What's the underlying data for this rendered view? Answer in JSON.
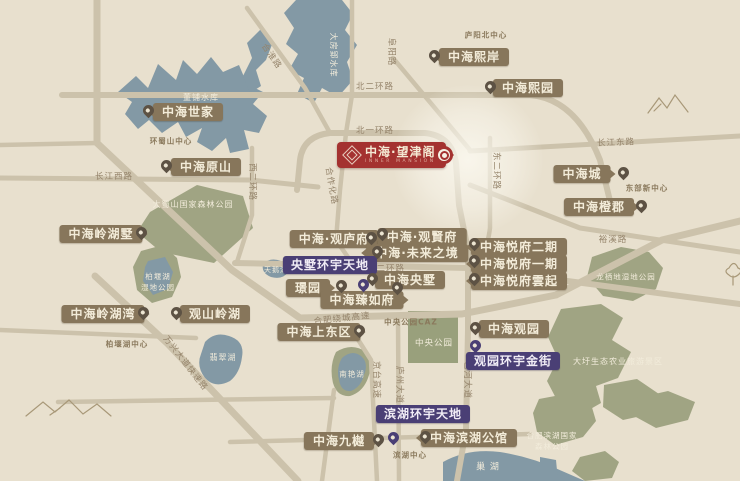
{
  "badge": {
    "name": "中海·望津阁",
    "subtitle": "INNER MANSION",
    "logo": "zhonghai-diamond"
  },
  "colors": {
    "accent_red": "#a43230",
    "label_brown": "#87765b",
    "hub_purple": "#4a3f75",
    "water_blue": "#8399a5",
    "park_green": "#a0a483",
    "road_tan": "#ccc2ab",
    "background": "#e8e0ce",
    "pin_brown": "#5d5244",
    "label_text": "#f3ecd9"
  },
  "projects": [
    {
      "label": "中海世家",
      "x": 188,
      "y": 112,
      "pin_x": 148,
      "pin_y": 118,
      "pin_side": "left"
    },
    {
      "label": "中海原山",
      "x": 206,
      "y": 167,
      "pin_x": 166,
      "pin_y": 173,
      "pin_side": "left"
    },
    {
      "label": "中海熙岸",
      "x": 474,
      "y": 57,
      "pin_x": 434,
      "pin_y": 63,
      "pin_side": "left"
    },
    {
      "label": "中海熙园",
      "x": 528,
      "y": 88,
      "pin_x": 490,
      "pin_y": 94,
      "pin_side": "left"
    },
    {
      "label": "中海岭湖墅",
      "x": 101,
      "y": 234,
      "pin_x": 141,
      "pin_y": 240,
      "pin_side": "right"
    },
    {
      "label": "中海岭湖湾",
      "x": 103,
      "y": 314,
      "pin_x": 143,
      "pin_y": 320,
      "pin_side": "right"
    },
    {
      "label": "观山岭湖",
      "x": 215,
      "y": 314,
      "pin_x": 176,
      "pin_y": 320,
      "pin_side": "left"
    },
    {
      "label": "中海·观庐府",
      "x": 334,
      "y": 239,
      "pin_x": 371,
      "pin_y": 245,
      "pin_side": "right"
    },
    {
      "label": "中海·观賢府",
      "x": 422,
      "y": 237,
      "pin_x": 382,
      "pin_y": 241,
      "pin_side": "left"
    },
    {
      "label": "中海·未来之境",
      "x": 417,
      "y": 253,
      "pin_x": 377,
      "pin_y": 259,
      "pin_side": "left"
    },
    {
      "label": "中海央墅",
      "x": 410,
      "y": 280,
      "pin_x": 372,
      "pin_y": 286,
      "pin_side": "left"
    },
    {
      "label": "璟园",
      "x": 308,
      "y": 288,
      "pin_x": 341,
      "pin_y": 293,
      "pin_side": "right"
    },
    {
      "label": "中海臻如府",
      "x": 362,
      "y": 300,
      "pin_x": 397,
      "pin_y": 295,
      "pin_side": "right"
    },
    {
      "label": "中海悦府二期",
      "x": 519,
      "y": 247,
      "pin_x": 474,
      "pin_y": 251,
      "pin_side": "left"
    },
    {
      "label": "中海悦府一期",
      "x": 519,
      "y": 264,
      "pin_x": 474,
      "pin_y": 268,
      "pin_side": "left"
    },
    {
      "label": "中海悦府雲起",
      "x": 519,
      "y": 281,
      "pin_x": 474,
      "pin_y": 286,
      "pin_side": "left"
    },
    {
      "label": "中海城",
      "x": 582,
      "y": 174,
      "pin_x": 623,
      "pin_y": 180,
      "pin_side": "right"
    },
    {
      "label": "中海橙郡",
      "x": 599,
      "y": 207,
      "pin_x": 641,
      "pin_y": 213,
      "pin_side": "right"
    },
    {
      "label": "中海观园",
      "x": 514,
      "y": 329,
      "pin_x": 475,
      "pin_y": 335,
      "pin_side": "left"
    },
    {
      "label": "中海上东区",
      "x": 319,
      "y": 332,
      "pin_x": 359,
      "pin_y": 338,
      "pin_side": "right"
    },
    {
      "label": "中海九樾",
      "x": 339,
      "y": 441,
      "pin_x": 378,
      "pin_y": 447,
      "pin_side": "right"
    },
    {
      "label": "中海滨湖公馆",
      "x": 469,
      "y": 438,
      "pin_x": 425,
      "pin_y": 444,
      "pin_side": "left"
    }
  ],
  "hubs": [
    {
      "label": "央墅环宇天地",
      "x": 330,
      "y": 265,
      "pin_x": 363,
      "pin_y": 292
    },
    {
      "label": "观园环宇金街",
      "x": 513,
      "y": 361,
      "pin_x": 475,
      "pin_y": 353
    },
    {
      "label": "滨湖环宇天地",
      "x": 423,
      "y": 414,
      "pin_x": 393,
      "pin_y": 445
    }
  ],
  "districts": [
    {
      "text": "庐阳北中心",
      "x": 486,
      "y": 35
    },
    {
      "text": "环蜀山中心",
      "x": 171,
      "y": 141
    },
    {
      "text": "东部新中心",
      "x": 647,
      "y": 188
    },
    {
      "text": "中央公园CAZ",
      "x": 411,
      "y": 322
    },
    {
      "text": "柏堰湖中心",
      "x": 127,
      "y": 344
    },
    {
      "text": "滨湖中心",
      "x": 410,
      "y": 455
    }
  ],
  "roads": [
    {
      "text": "北二环路",
      "x": 375,
      "y": 86,
      "rotate": 0
    },
    {
      "text": "北一环路",
      "x": 375,
      "y": 130,
      "rotate": 0
    },
    {
      "text": "阜阳路",
      "x": 392,
      "y": 52,
      "rotate": 90
    },
    {
      "text": "合淮路",
      "x": 272,
      "y": 56,
      "rotate": 55
    },
    {
      "text": "西二环路",
      "x": 253,
      "y": 182,
      "rotate": 90
    },
    {
      "text": "合作化路",
      "x": 332,
      "y": 186,
      "rotate": 80
    },
    {
      "text": "长江西路",
      "x": 114,
      "y": 176,
      "rotate": 0
    },
    {
      "text": "长江东路",
      "x": 616,
      "y": 142,
      "rotate": -2
    },
    {
      "text": "东二环路",
      "x": 497,
      "y": 171,
      "rotate": 90
    },
    {
      "text": "裕溪路",
      "x": 613,
      "y": 239,
      "rotate": 0
    },
    {
      "text": "南二环路",
      "x": 386,
      "y": 268,
      "rotate": 0
    },
    {
      "text": "合肥绕城高速",
      "x": 342,
      "y": 318,
      "rotate": -6
    },
    {
      "text": "万兴大道快速路",
      "x": 186,
      "y": 363,
      "rotate": 52
    },
    {
      "text": "京台高速",
      "x": 377,
      "y": 380,
      "rotate": 90
    },
    {
      "text": "庐州大道",
      "x": 400,
      "y": 385,
      "rotate": 90
    },
    {
      "text": "包河大道",
      "x": 468,
      "y": 380,
      "rotate": 90
    }
  ],
  "nature": [
    {
      "text": "董铺水库",
      "x": 201,
      "y": 98,
      "rotate": 0,
      "size": 8
    },
    {
      "text": "大房郢水库",
      "x": 333,
      "y": 55,
      "rotate": 90,
      "size": 8
    },
    {
      "text": "大蜀山国家森林公园",
      "x": 193,
      "y": 205,
      "rotate": 0,
      "size": 8
    },
    {
      "text": "柏堰湖\n湿地公园",
      "x": 158,
      "y": 282,
      "rotate": 0,
      "size": 7.5
    },
    {
      "text": "天鹅湖",
      "x": 276,
      "y": 270,
      "rotate": 0,
      "size": 7
    },
    {
      "text": "翡翠湖",
      "x": 223,
      "y": 358,
      "rotate": 0,
      "size": 8
    },
    {
      "text": "南艳湖",
      "x": 352,
      "y": 374,
      "rotate": 0,
      "size": 7.5
    },
    {
      "text": "中央公园",
      "x": 434,
      "y": 344,
      "rotate": 0,
      "size": 8.5
    },
    {
      "text": "龙栖地湿地公园",
      "x": 626,
      "y": 277,
      "rotate": 0,
      "size": 7.5
    },
    {
      "text": "大圩生态农业旅游景区",
      "x": 618,
      "y": 362,
      "rotate": 0,
      "size": 8
    },
    {
      "text": "合肥滨湖国家\n森林公园",
      "x": 552,
      "y": 441,
      "rotate": 0,
      "size": 7.5
    },
    {
      "text": "巢  湖",
      "x": 488,
      "y": 468,
      "rotate": 0,
      "size": 9
    }
  ]
}
